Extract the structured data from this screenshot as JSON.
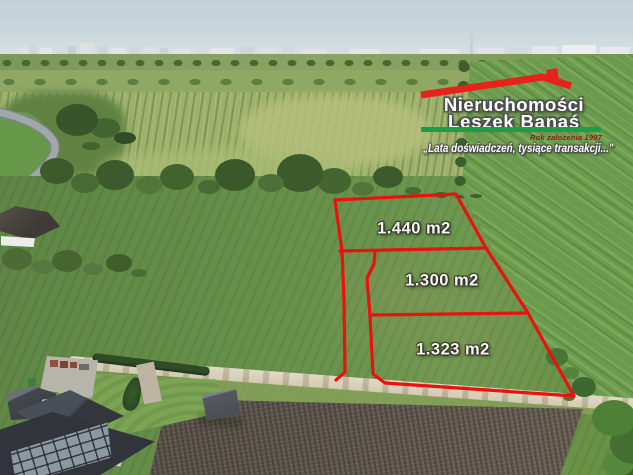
{
  "photo": {
    "description": "Aerial drone photo of farmland with three building plots for sale outlined in red"
  },
  "logo": {
    "line1": "Nieruchomości",
    "line2": "Leszek Banaś",
    "founded": "Rok założenia 1997",
    "tagline": "„Lata doświadczeń, tysiące transakcji...\"",
    "roof_color": "#e6231a",
    "underline_color": "#1a9f45",
    "founded_color": "#8a170c"
  },
  "plots": {
    "outline_color": "#e9120e",
    "items": [
      {
        "area_label": "1.440 m2"
      },
      {
        "area_label": "1.300 m2"
      },
      {
        "area_label": "1.323 m2"
      }
    ]
  }
}
